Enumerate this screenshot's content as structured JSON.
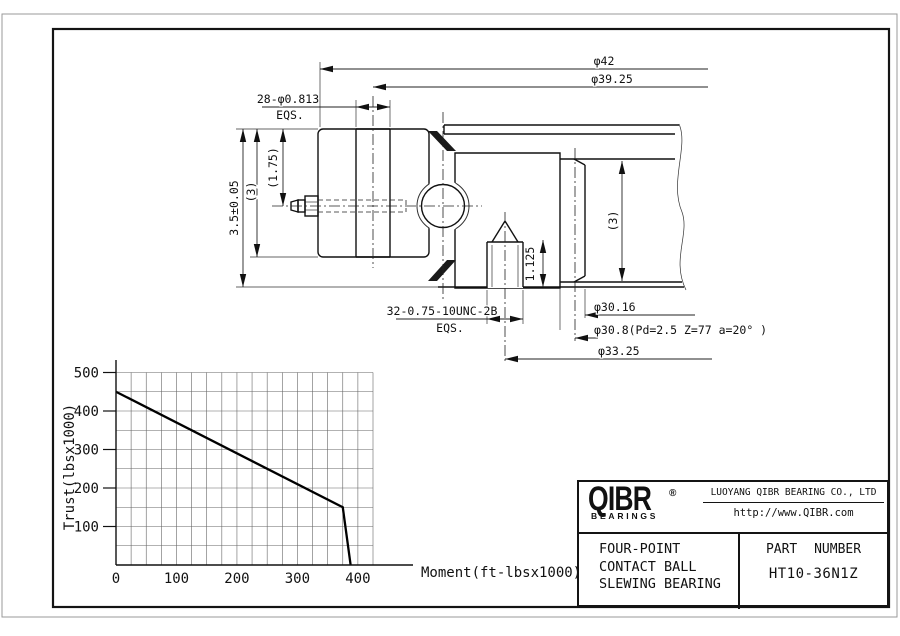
{
  "drawing": {
    "dims": {
      "outer_dia": "φ42",
      "bolt_circle": "φ39.25",
      "mount_holes": "28-φ0.813",
      "mount_holes_eqs": "EQS.",
      "height_total": "3.5±0.05",
      "height_outer": "(3)",
      "height_to_center": "(1.75)",
      "height_inner": "(3)",
      "thread_holes": "32-0.75-10UNC-2B",
      "thread_holes_eqs": "EQS.",
      "thread_depth": "1.125",
      "gear_tip_dia": "φ30.16",
      "gear_pitch": "φ30.8(Pd=2.5 Z=77 a=20° )",
      "thread_circle": "φ33.25"
    }
  },
  "chart_data": {
    "type": "line",
    "title": "Static load capacity curve",
    "xlabel": "Moment(ft-lbsx1000)",
    "ylabel": "Trust(lbsx1000)",
    "xlim": [
      0,
      425
    ],
    "ylim": [
      0,
      500
    ],
    "x_ticks": [
      0,
      100,
      200,
      300,
      400
    ],
    "y_ticks": [
      100,
      200,
      300,
      400,
      500
    ],
    "x_minor_step": 25,
    "y_minor_step": 50,
    "grid": true,
    "legend": false,
    "series": [
      {
        "name": "load-limit",
        "points": [
          [
            0,
            450
          ],
          [
            375,
            150
          ],
          [
            388,
            0
          ]
        ]
      }
    ]
  },
  "title_block": {
    "logo_text": "QIBR",
    "logo_reg": "®",
    "logo_sub": "BEARINGS",
    "company": "LUOYANG QIBR BEARING CO., LTD",
    "website": "http://www.QIBR.com",
    "product_lines": [
      "FOUR-POINT",
      "CONTACT BALL",
      "SLEWING BEARING"
    ],
    "part_number_label": "PART NUMBER",
    "part_number": "HT10-36N1Z"
  },
  "colors": {
    "line": "#111111",
    "hatch": "#555555",
    "grid": "#666666",
    "frame": "#141414",
    "outer_border": "#999999"
  }
}
